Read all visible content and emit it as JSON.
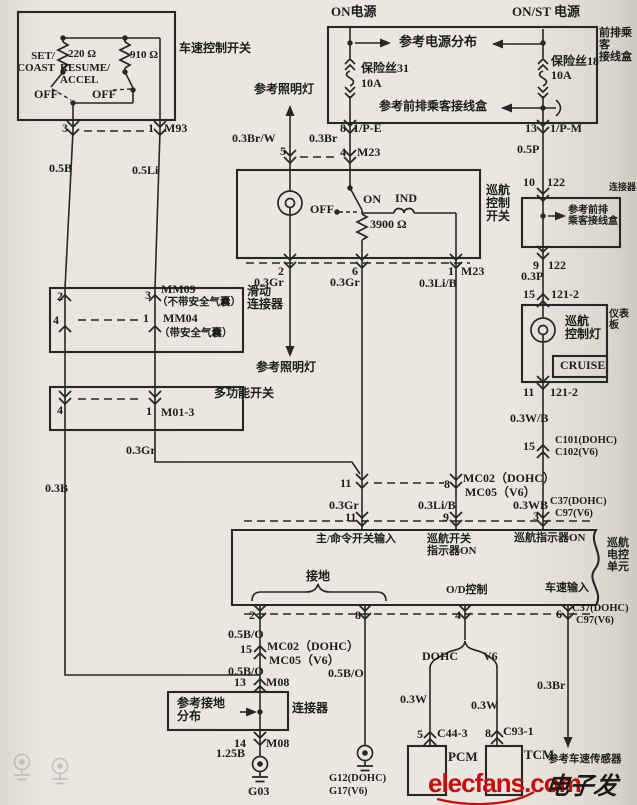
{
  "speed_switch": {
    "title": "车速控制开关",
    "set_coast": "SET/\nCOAST",
    "r220": "220 Ω",
    "resume_accel": "RESUME/\nACCEL",
    "r910": "910 Ω",
    "off_left": "OFF",
    "off_right": "OFF",
    "pin3": "3",
    "pin1": "1",
    "conn": "M93",
    "wire_left": "0.5B",
    "wire_right": "0.5Li"
  },
  "clockspring": {
    "pin2": "2",
    "pin3": "3",
    "name1": "MM09",
    "note1": "（不带安全气囊）",
    "pin4": "4",
    "pin1": "1",
    "name2": "MM04",
    "note2": "（带安全气囊）",
    "slide": "滑动\n连接器"
  },
  "multi_switch": {
    "pin4": "4",
    "pin1": "1",
    "conn": "M01-3",
    "label": "多功能开关",
    "wire_gr": "0.3Gr",
    "wire_b": "0.3B"
  },
  "power": {
    "on": "ON电源",
    "onst": "ON/ST 电源",
    "ref_dist": "参考电源分布",
    "fuse31": "保险丝31",
    "fuse31_amp": "10A",
    "fuse18": "保险丝18",
    "fuse18_amp": "10A",
    "box_label": "前排乘客\n接线盒",
    "ref_junction": "参考前排乘客接线盒",
    "pin8": "8",
    "conn_pe": "1/P-E",
    "pin13": "13",
    "conn_pm": "1/P-M",
    "wire_brw": "0.3Br/W",
    "wire_br": "0.3Br",
    "wire_p": "0.5P",
    "ref_illum": "参考照明灯",
    "pin5": "5",
    "pin4": "4",
    "m23": "M23"
  },
  "right_chain": {
    "pin10": "10",
    "c122a": "122",
    "conn_label": "连接器",
    "ref_junction2": "参考前排\n乘客接线盒",
    "pin9": "9",
    "c122b": "122",
    "wire_p3": "0.3P",
    "pin15": "15",
    "c121a": "121-2",
    "panel": "仪表板",
    "lamp": "巡航\n控制灯",
    "cruise": "CRUISE",
    "pin11": "11",
    "c121b": "121-2",
    "wire_wb": "0.3W/B",
    "pin15b": "15",
    "c101": "C101(DOHC)",
    "c102": "C102(V6)"
  },
  "cruise_switch": {
    "label": "巡航\n控制\n开关",
    "off": "OFF",
    "on": "ON",
    "ind": "IND",
    "res": "3900 Ω",
    "pin2": "2",
    "pin6": "6",
    "pin1": "1",
    "m23": "M23",
    "wire1": "0.3Gr",
    "wire2": "0.3Gr",
    "wire3": "0.3Li/B",
    "ref_illum": "参考照明灯"
  },
  "mc_connector": {
    "pin11": "11",
    "pin8": "8",
    "name1": "MC02（DOHC）",
    "name2": "MC05（V6）",
    "wire1": "0.3Gr",
    "wire2": "0.3Li/B",
    "wire3": "0.3WB"
  },
  "ecu": {
    "pin11": "11",
    "pin9": "9",
    "pin3": "3",
    "c37": "C37(DOHC)",
    "c97": "C97(V6)",
    "in_main": "主/命令开关输入",
    "in_sw": "巡航开关\n指示器ON",
    "in_ind": "巡航指示器ON",
    "unit": "巡航\n电控\n单元",
    "gnd": "接地",
    "od": "O/D控制",
    "vss": "车速输入",
    "pin2": "2",
    "pin8": "8",
    "pin4": "4",
    "pin6": "6",
    "c37b": "C37(DOHC)",
    "c97b": "C97(V6)"
  },
  "ground_chain": {
    "w1": "0.5B/O",
    "pin15": "15",
    "name1": "MC02（DOHC）",
    "name2": "MC05（V6）",
    "w2": "0.5B/O",
    "pin13": "13",
    "m08a": "M08",
    "ref_gnd": "参考接地\n分布",
    "conn": "连接器",
    "pin14": "14",
    "m08b": "M08",
    "w3": "1.25B",
    "g03": "G03",
    "w4": "0.5B/O",
    "g12": "G12(DOHC)",
    "g17": "G17(V6)"
  },
  "od_branch": {
    "dohc": "DOHC",
    "v6": "V6",
    "w1": "0.3W",
    "w2": "0.3W",
    "pin5": "5",
    "c443": "C44-3",
    "pcm": "PCM",
    "pin8": "8",
    "c931": "C93-1",
    "tcm": "TCM"
  },
  "vss": {
    "wire": "0.3Br",
    "ref": "参考车速传感器"
  },
  "watermark": {
    "site": "elecfans.com",
    "slogan": "电子发烧友"
  }
}
